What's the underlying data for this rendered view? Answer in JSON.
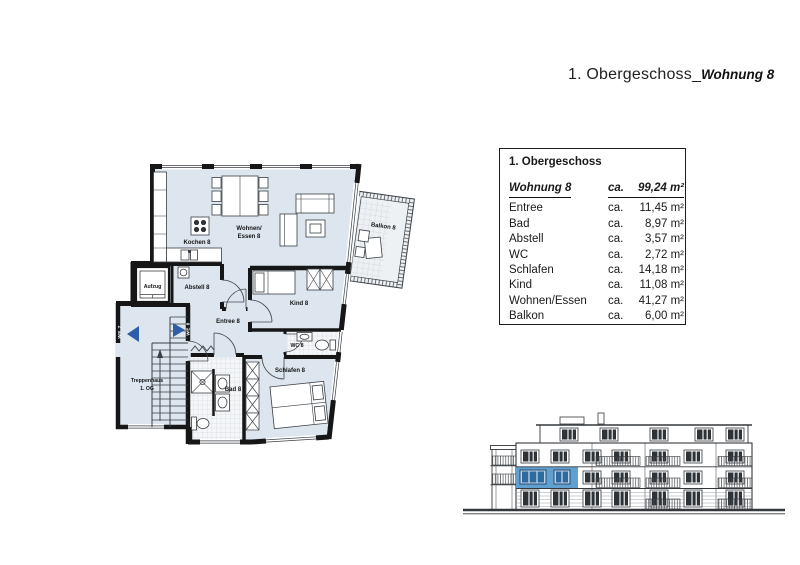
{
  "title": {
    "floor": "1. Obergeschoss_",
    "unit": "Wohnung 8"
  },
  "info_table": {
    "header": "1. Obergeschoss",
    "unit": {
      "label": "Wohnung 8",
      "prefix": "ca.",
      "value": "99,24 m²"
    },
    "rows": [
      {
        "room": "Entree",
        "prefix": "ca.",
        "value": "11,45 m²"
      },
      {
        "room": "Bad",
        "prefix": "ca.",
        "value": "8,97 m²"
      },
      {
        "room": "Abstell",
        "prefix": "ca.",
        "value": "3,57 m²"
      },
      {
        "room": "WC",
        "prefix": "ca.",
        "value": "2,72 m²"
      },
      {
        "room": "Schlafen",
        "prefix": "ca.",
        "value": "14,18 m²"
      },
      {
        "room": "Kind",
        "prefix": "ca.",
        "value": "11,08 m²"
      },
      {
        "room": "Wohnen/Essen",
        "prefix": "ca.",
        "value": "41,27 m²"
      },
      {
        "room": "Balkon",
        "prefix": "ca.",
        "value": "6,00 m²"
      }
    ]
  },
  "floor_plan": {
    "rooms": {
      "kochen": "Kochen 8",
      "wohnen_line1": "Wohnen/",
      "wohnen_line2": "Essen 8",
      "balkon": "Balkon 8",
      "aufzug": "Aufzug",
      "abstell": "Abstell 8",
      "kind": "Kind 8",
      "entree": "Entree 8",
      "wc": "WC 8",
      "schlafen": "Schlafen 8",
      "bad": "Bad 8",
      "treppenhaus_line1": "Treppenhaus",
      "treppenhaus_line2": "1. OG"
    },
    "entrances": {
      "we7": "WE 7",
      "we8": "WE 8"
    }
  },
  "colors": {
    "room_fill": "#dde5ee",
    "wall": "#161616",
    "arrow": "#2d5da9",
    "tile_fill": "#f4f6f8",
    "balcony_fill": "#eef1f4",
    "highlight": "#62a0cf",
    "window_dark": "#2e3338",
    "line": "#34383c"
  }
}
